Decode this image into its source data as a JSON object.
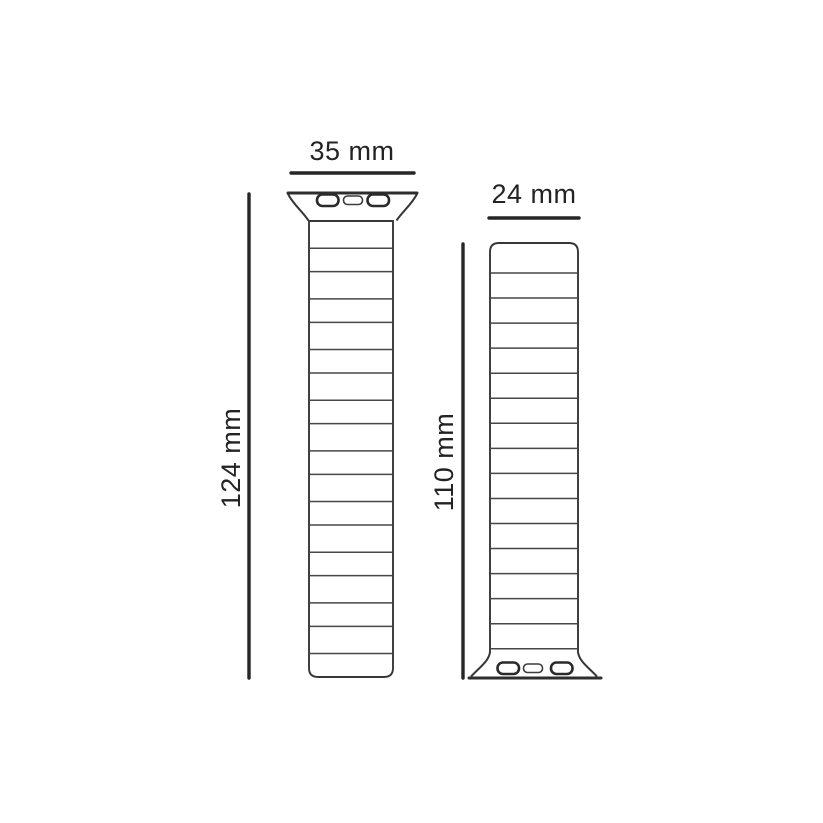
{
  "diagram": {
    "title": "watch-band-dimension-drawing",
    "background_color": "#ffffff",
    "line_color": "#2e2e2e",
    "text_color": "#232323",
    "straps": [
      {
        "id": "left-strap",
        "width_label": "35 mm",
        "length_label": "124 mm",
        "adapter_position": "top",
        "adapter_slots": 3,
        "links": 18
      },
      {
        "id": "right-strap",
        "width_label": "24 mm",
        "length_label": "110 mm",
        "adapter_position": "bottom",
        "adapter_slots": 3,
        "links": 17
      }
    ]
  }
}
